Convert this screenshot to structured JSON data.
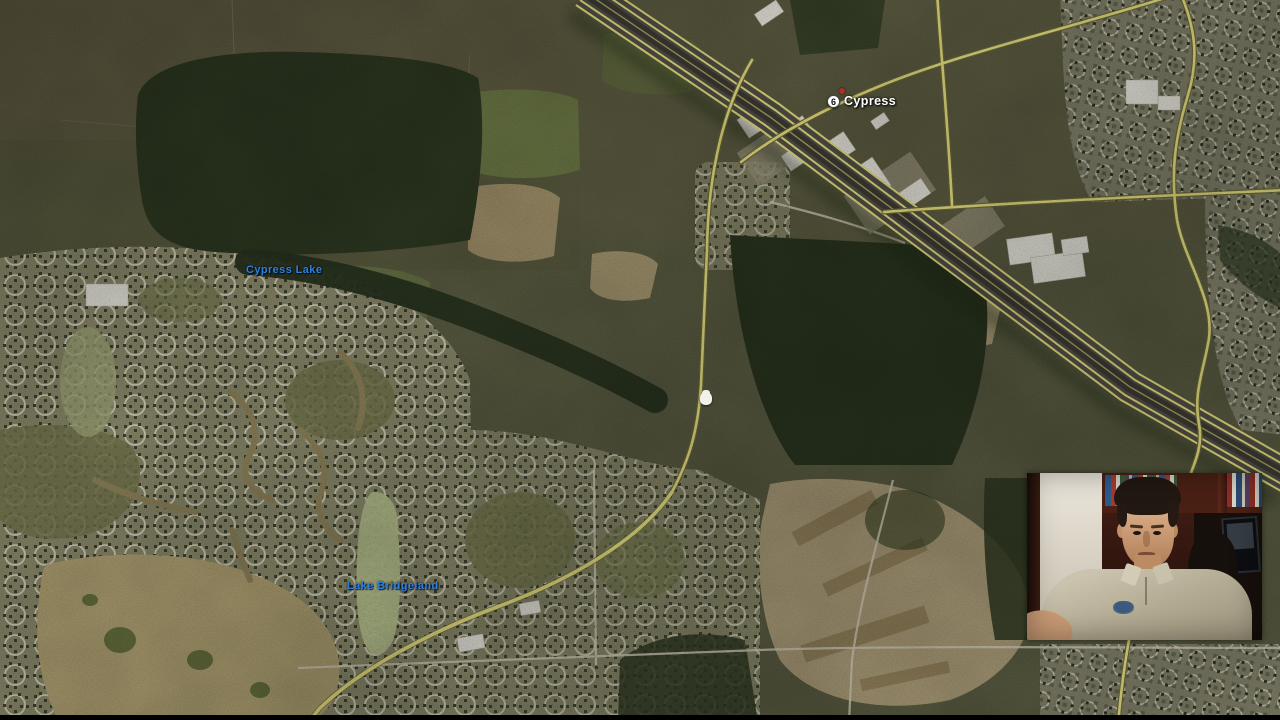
{
  "map": {
    "poi": {
      "name": "Cypress",
      "shield": "6"
    },
    "water_labels": {
      "cypress_lake": "Cypress Lake",
      "lake_bridgeland": "Lake Bridgeland"
    }
  },
  "colors": {
    "road-yellow": "#ece584",
    "label-blue": "#2f82d8",
    "marker-red": "#b03024",
    "poi-white": "#ffffff"
  }
}
